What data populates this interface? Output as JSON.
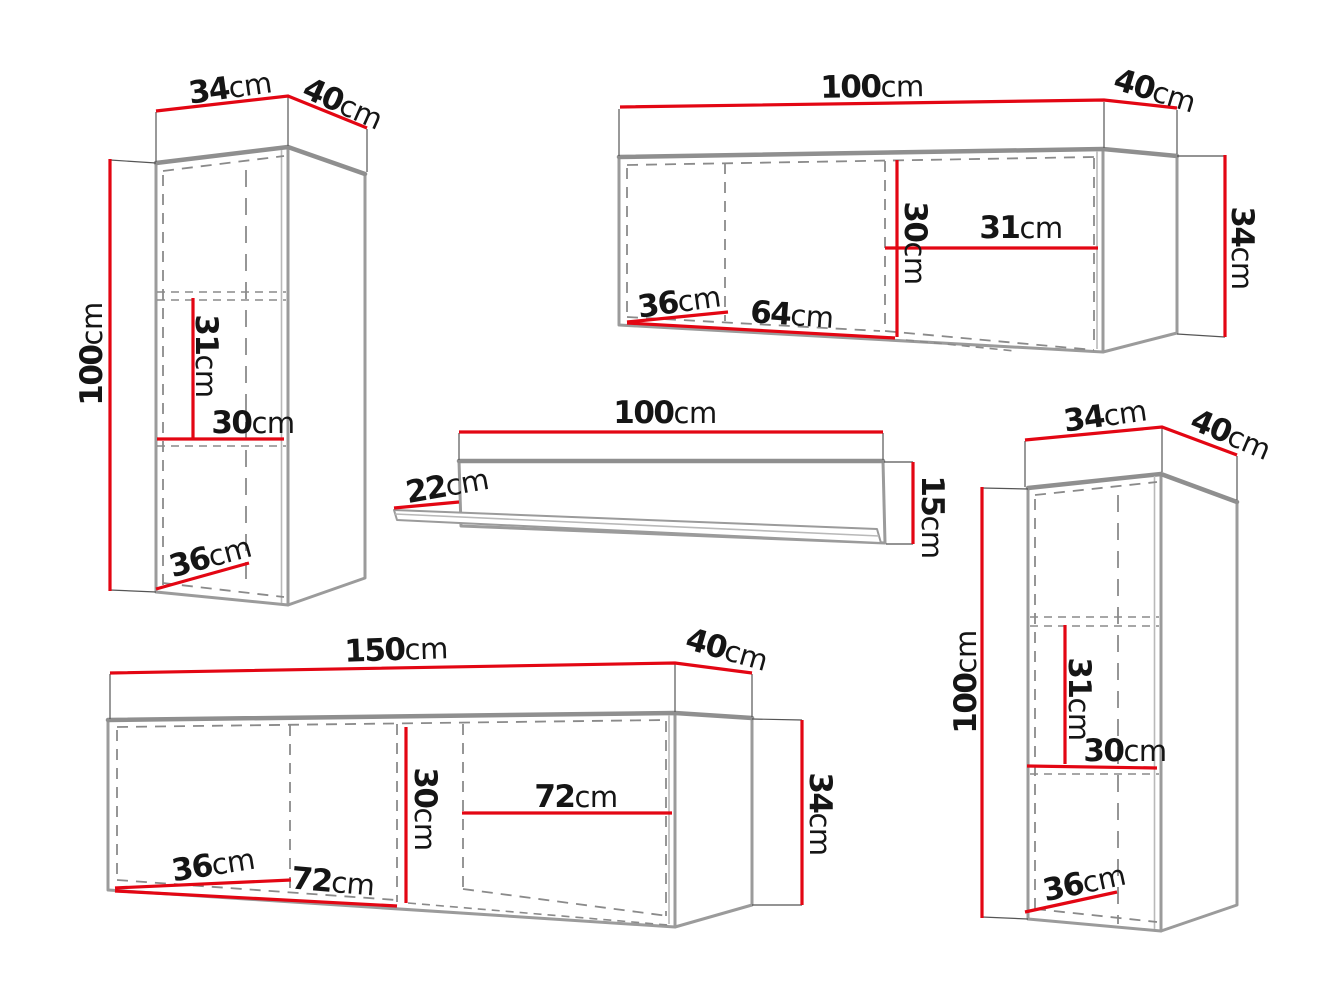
{
  "unit": "cm",
  "colors": {
    "dimension_line": "#e30613",
    "cabinet_outline": "#9b9b9b",
    "hidden_line": "#8a8a8a",
    "label_text": "#151515"
  },
  "pieces": {
    "top_left_cabinet": {
      "width": "34",
      "depth": "40",
      "height": "100",
      "upper_section_height": "31",
      "interior_width": "30",
      "interior_depth": "36"
    },
    "top_right_cabinet": {
      "width": "100",
      "depth": "40",
      "height": "34",
      "interior_height": "30",
      "right_section_width": "31",
      "left_section_width": "64",
      "interior_depth": "36"
    },
    "wall_shelf": {
      "width": "100",
      "depth": "22",
      "height": "15"
    },
    "bottom_cabinet": {
      "width": "150",
      "depth": "40",
      "height": "34",
      "interior_height": "30",
      "right_section_width": "72",
      "left_section_width": "72",
      "interior_depth": "36"
    },
    "right_cabinet": {
      "width": "34",
      "depth": "40",
      "height": "100",
      "upper_section_height": "31",
      "interior_width": "30",
      "interior_depth": "36"
    }
  }
}
